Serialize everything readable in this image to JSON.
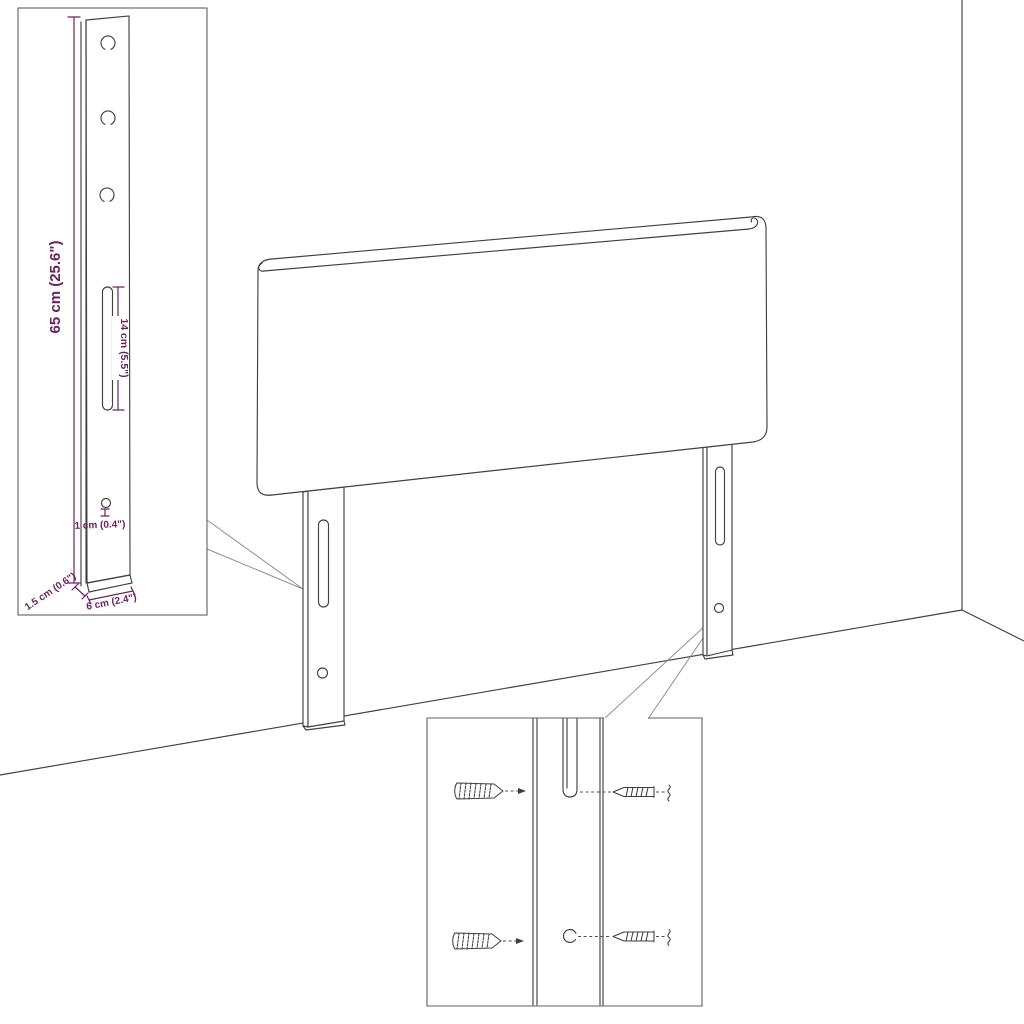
{
  "dimension_labels": {
    "bracket_height": "65 cm (25.6\")",
    "slot_length": "14 cm (5.5\")",
    "hole_size": "1 cm (0.4\")",
    "bracket_thickness": "1.5 cm (0.6\")",
    "bracket_width": "6 cm (2.4\")"
  },
  "colors": {
    "line": "#414141",
    "box_border": "#5f5f5f",
    "dimension_text": "#692360",
    "background": "#ffffff"
  },
  "icons": {
    "screw": "screw-icon",
    "mounting_hole": "mounting-hole-icon",
    "mounting_slot": "mounting-slot-icon"
  }
}
